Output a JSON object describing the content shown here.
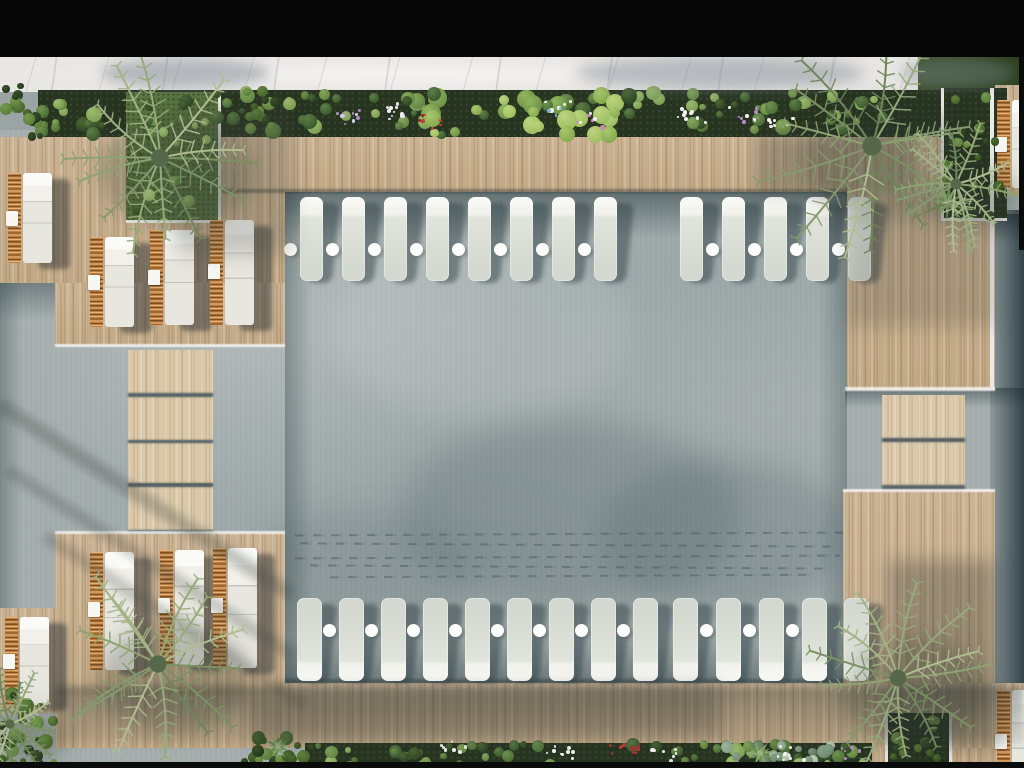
{
  "scene": {
    "w": 1024,
    "h": 768,
    "description": "aerial-top-view-pool-deck-render"
  },
  "colors": {
    "water": "#a6afae",
    "deck_wood": "#c7ae8c",
    "bridge_wood": "#dac8a9",
    "walkway_marble": "#e9e7e4",
    "planter_soil": "#273420",
    "grass": "#5a7440",
    "lounger_white": "#f1f2ec",
    "rattan_orange": "#c07f3e",
    "letterbox": "#060606"
  },
  "palettes": {
    "palm": [
      "#8ea272",
      "#7b9164",
      "#a3b386",
      "#6f855c",
      "#97aa7c",
      "#b0bd90",
      "#86996e"
    ],
    "leaf": [
      [
        "#3c5a2e",
        "#5d7f46"
      ],
      [
        "#4e7038",
        "#6f934e"
      ],
      [
        "#648844",
        "#86a85c"
      ],
      [
        "#2f4724",
        "#4c6636"
      ],
      [
        "#7fa055",
        "#9cbc6e"
      ]
    ],
    "lush": [
      [
        "#4e7038",
        "#6f934e"
      ],
      [
        "#6f9347",
        "#92b55e"
      ],
      [
        "#86ab4f",
        "#a8c86a"
      ],
      [
        "#3c5a2e",
        "#5d7f46"
      ],
      [
        "#9fc063",
        "#bcd47f"
      ]
    ],
    "bush": [
      [
        "#24371d",
        "#3a5229"
      ],
      [
        "#35511f",
        "#4f6e31"
      ],
      [
        "#47662c",
        "#62843e"
      ],
      [
        "#5b7f3a",
        "#77994f"
      ]
    ],
    "sage": [
      [
        "#6f8a70",
        "#8aa38b"
      ],
      [
        "#8aa38b",
        "#a7bba4"
      ],
      [
        "#a7bba4",
        "#c2d0bd"
      ],
      [
        "#5d7660",
        "#7a9480"
      ]
    ]
  },
  "rects": [
    {
      "n": "water-surface",
      "c": "water",
      "x": 0,
      "y": 130,
      "w": 1024,
      "h": 636,
      "z": 1
    },
    {
      "n": "water-sun-glint",
      "x": 330,
      "y": 240,
      "w": 300,
      "h": 180,
      "z": 2,
      "bg": "rgba(255,255,255,.10)",
      "br": "50%",
      "bl": 14
    },
    {
      "n": "water-shadow-blob-1",
      "x": 400,
      "y": 420,
      "w": 340,
      "h": 190,
      "z": 2,
      "bg": "rgba(64,82,88,.22)",
      "br": "50%",
      "bl": 16
    },
    {
      "n": "water-shadow-blob-2",
      "x": 600,
      "y": 460,
      "w": 250,
      "h": 150,
      "z": 2,
      "bg": "rgba(58,78,86,.20)",
      "br": "50%",
      "bl": 14
    },
    {
      "n": "water-shadow-blob-3",
      "x": 240,
      "y": 510,
      "w": 230,
      "h": 130,
      "z": 2,
      "bg": "rgba(70,88,92,.16)",
      "br": "50%",
      "bl": 14
    },
    {
      "n": "pool-edge-shade-top",
      "x": 285,
      "y": 192,
      "w": 562,
      "h": 46,
      "z": 4,
      "bg": "linear-gradient(180deg,rgba(30,50,54,.50),rgba(30,50,54,0))"
    },
    {
      "n": "pool-edge-shade-bottom",
      "x": 285,
      "y": 634,
      "w": 562,
      "h": 49,
      "z": 4,
      "bg": "linear-gradient(0deg,rgba(30,50,54,.40),rgba(30,50,54,0))"
    },
    {
      "n": "pool-edge-shade-left",
      "x": 285,
      "y": 192,
      "w": 28,
      "h": 491,
      "z": 4,
      "bg": "linear-gradient(90deg,rgba(30,50,54,.32),rgba(30,50,54,0))"
    },
    {
      "n": "pool-edge-shade-right",
      "x": 818,
      "y": 192,
      "w": 29,
      "h": 491,
      "z": 4,
      "bg": "linear-gradient(270deg,rgba(30,50,54,.28),rgba(30,50,54,0))"
    },
    {
      "n": "left-arm-shade-top",
      "x": 0,
      "y": 283,
      "w": 128,
      "h": 38,
      "z": 4,
      "bg": "linear-gradient(180deg,rgba(30,50,54,.38),rgba(30,50,54,0))"
    },
    {
      "n": "left-arm-shade-edge",
      "x": 0,
      "y": 283,
      "w": 22,
      "h": 332,
      "z": 4,
      "bg": "linear-gradient(90deg,rgba(30,50,54,.30),rgba(30,50,54,0))"
    },
    {
      "n": "right-channel-water",
      "x": 990,
      "y": 210,
      "w": 34,
      "h": 486,
      "z": 4,
      "bg": "linear-gradient(90deg,rgba(52,74,80,.20),rgba(22,40,48,.80))"
    },
    {
      "n": "right-channel-shade-top",
      "x": 990,
      "y": 214,
      "w": 34,
      "h": 30,
      "z": 5,
      "bg": "linear-gradient(180deg,rgba(18,34,40,.55),rgba(18,34,40,0))"
    },
    {
      "n": "steps-channel-shade",
      "x": 845,
      "y": 388,
      "w": 179,
      "h": 20,
      "z": 5,
      "bg": "linear-gradient(180deg,rgba(24,42,46,.45),rgba(24,42,46,0))"
    },
    {
      "n": "walkway",
      "c": "marble",
      "x": 0,
      "y": 57,
      "w": 1024,
      "h": 35,
      "z": 6
    },
    {
      "n": "lawn-patch",
      "x": 918,
      "y": 57,
      "w": 101,
      "h": 35,
      "z": 7,
      "bg": "linear-gradient(90deg,#3b522d,#2b3f1f)"
    },
    {
      "n": "deck-top-strip",
      "c": "wood",
      "x": 0,
      "y": 137,
      "w": 847,
      "h": 55,
      "z": 10
    },
    {
      "n": "deck-top-left-upper",
      "c": "wood",
      "x": 0,
      "y": 137,
      "w": 285,
      "h": 146,
      "z": 10
    },
    {
      "n": "deck-top-left-lower",
      "c": "wood",
      "x": 55,
      "y": 283,
      "w": 230,
      "h": 62,
      "z": 10
    },
    {
      "n": "deck-right-column",
      "c": "wood",
      "x": 847,
      "y": 137,
      "w": 148,
      "h": 253,
      "z": 10
    },
    {
      "n": "deck-right-lower",
      "c": "wood",
      "x": 843,
      "y": 490,
      "w": 152,
      "h": 278,
      "z": 10
    },
    {
      "n": "deck-bottom-strip",
      "c": "wood",
      "x": 55,
      "y": 683,
      "w": 969,
      "h": 65,
      "z": 10
    },
    {
      "n": "deck-bottom-left-platform",
      "c": "wood",
      "x": 55,
      "y": 533,
      "w": 230,
      "h": 162,
      "z": 10
    },
    {
      "n": "deck-pad-right-top",
      "c": "wood",
      "x": 995,
      "y": 85,
      "w": 29,
      "h": 110,
      "z": 10
    },
    {
      "n": "deck-pad-right-bottom",
      "c": "wood",
      "x": 995,
      "y": 683,
      "w": 29,
      "h": 85,
      "z": 10
    },
    {
      "n": "deck-pad-left",
      "c": "wood",
      "x": 0,
      "y": 608,
      "w": 58,
      "h": 105,
      "z": 10
    },
    {
      "n": "bridge-step-1",
      "c": "woodLight",
      "x": 128,
      "y": 350,
      "w": 85,
      "h": 43,
      "z": 10
    },
    {
      "n": "bridge-step-2",
      "c": "woodLight",
      "x": 128,
      "y": 397,
      "w": 85,
      "h": 43,
      "z": 10
    },
    {
      "n": "bridge-step-3",
      "c": "woodLight",
      "x": 128,
      "y": 443,
      "w": 85,
      "h": 40,
      "z": 10
    },
    {
      "n": "bridge-step-4",
      "c": "woodLight",
      "x": 128,
      "y": 487,
      "w": 85,
      "h": 43,
      "z": 10
    },
    {
      "n": "pool-step-1",
      "c": "woodLight",
      "x": 882,
      "y": 395,
      "w": 83,
      "h": 43,
      "z": 10
    },
    {
      "n": "pool-step-2",
      "c": "woodLight",
      "x": 882,
      "y": 442,
      "w": 83,
      "h": 43,
      "z": 10
    },
    {
      "n": "deck-lip-top",
      "x": 213,
      "y": 189,
      "w": 634,
      "h": 4,
      "z": 11,
      "bg": "rgba(28,42,44,.40)",
      "bl": 1
    },
    {
      "n": "deck-lip-bottom",
      "x": 285,
      "y": 679,
      "w": 562,
      "h": 4,
      "z": 11,
      "bg": "rgba(28,42,44,.35)",
      "bl": 1
    },
    {
      "n": "bridge-gap-1",
      "x": 128,
      "y": 393,
      "w": 85,
      "h": 4,
      "z": 11,
      "bg": "rgba(16,26,28,.55)",
      "bl": 1
    },
    {
      "n": "bridge-gap-2",
      "x": 128,
      "y": 440,
      "w": 85,
      "h": 3,
      "z": 11,
      "bg": "rgba(16,26,28,.55)",
      "bl": 1
    },
    {
      "n": "bridge-gap-3",
      "x": 128,
      "y": 483,
      "w": 85,
      "h": 4,
      "z": 11,
      "bg": "rgba(16,26,28,.55)",
      "bl": 1
    },
    {
      "n": "bridge-gap-4",
      "x": 128,
      "y": 530,
      "w": 85,
      "h": 3,
      "z": 11,
      "bg": "rgba(16,26,28,.50)",
      "bl": 1
    },
    {
      "n": "pool-step-gap-1",
      "x": 882,
      "y": 438,
      "w": 83,
      "h": 4,
      "z": 11,
      "bg": "rgba(16,26,28,.55)",
      "bl": 1
    },
    {
      "n": "pool-step-gap-2",
      "x": 882,
      "y": 485,
      "w": 83,
      "h": 5,
      "z": 11,
      "bg": "rgba(16,26,28,.50)",
      "bl": 1
    },
    {
      "n": "planter-top",
      "c": "planterBed",
      "x": 38,
      "y": 90,
      "w": 905,
      "h": 47,
      "z": 12
    },
    {
      "n": "planter-bottom",
      "c": "planterBed",
      "x": 305,
      "y": 743,
      "w": 567,
      "h": 25,
      "z": 12
    },
    {
      "n": "planter-box-top-right",
      "c": "planterBed",
      "x": 943,
      "y": 88,
      "w": 64,
      "h": 132,
      "z": 12
    },
    {
      "n": "planter-box-bottom-right",
      "c": "planterBed",
      "x": 887,
      "y": 713,
      "w": 65,
      "h": 53,
      "z": 12
    },
    {
      "n": "palm-planter-grass",
      "c": "grass",
      "x": 126,
      "y": 92,
      "w": 92,
      "h": 129,
      "z": 12
    },
    {
      "n": "planter-frame",
      "c": "frame",
      "x": 218,
      "y": 92,
      "w": 3,
      "h": 131,
      "z": 13
    },
    {
      "n": "planter-frame",
      "c": "frame",
      "x": 126,
      "y": 220,
      "w": 95,
      "h": 3,
      "z": 13
    },
    {
      "n": "planter-frame",
      "c": "frame",
      "x": 941,
      "y": 88,
      "w": 3,
      "h": 133,
      "z": 13
    },
    {
      "n": "planter-frame",
      "c": "frame",
      "x": 941,
      "y": 218,
      "w": 66,
      "h": 3,
      "z": 13
    },
    {
      "n": "planter-frame",
      "c": "frame",
      "x": 885,
      "y": 713,
      "w": 3,
      "h": 53,
      "z": 13
    },
    {
      "n": "planter-frame",
      "c": "frame",
      "x": 949,
      "y": 713,
      "w": 3,
      "h": 53,
      "z": 13
    },
    {
      "n": "water-edge-foam",
      "c": "foam",
      "x": 55,
      "y": 344,
      "w": 230,
      "h": 3,
      "z": 15
    },
    {
      "n": "water-edge-foam",
      "c": "foam",
      "x": 55,
      "y": 531,
      "w": 230,
      "h": 3,
      "z": 15
    },
    {
      "n": "water-edge-foam",
      "c": "foam",
      "x": 845,
      "y": 387,
      "w": 150,
      "h": 4,
      "z": 15
    },
    {
      "n": "water-edge-foam",
      "c": "foam",
      "x": 843,
      "y": 489,
      "w": 152,
      "h": 3,
      "z": 15
    },
    {
      "n": "deck-edge-highlight",
      "c": "frame",
      "x": 990,
      "y": 88,
      "w": 4,
      "h": 300,
      "z": 15
    },
    {
      "n": "shadow-overlay",
      "x": 100,
      "y": 58,
      "w": 170,
      "h": 30,
      "z": 30,
      "bg": "rgba(124,134,146,.50)",
      "br": "50%",
      "bl": 6
    },
    {
      "n": "shadow-overlay",
      "x": 575,
      "y": 56,
      "w": 290,
      "h": 34,
      "z": 30,
      "bg": "rgba(118,128,140,.45)",
      "br": "50%",
      "bl": 7
    },
    {
      "n": "shadow-overlay",
      "x": 900,
      "y": 58,
      "w": 115,
      "h": 30,
      "z": 30,
      "bg": "rgba(124,134,146,.40)",
      "br": "50%",
      "bl": 6
    },
    {
      "n": "shadow-overlay",
      "x": 176,
      "y": 110,
      "w": 115,
      "h": 145,
      "z": 30,
      "bg": "rgba(62,66,60,.25)",
      "bl": 9
    },
    {
      "n": "shadow-overlay",
      "x": 756,
      "y": 134,
      "w": 160,
      "h": 60,
      "z": 30,
      "bg": "rgba(52,58,54,.30)",
      "bl": 7
    },
    {
      "n": "shadow-overlay",
      "x": 846,
      "y": 196,
      "w": 150,
      "h": 130,
      "z": 30,
      "bg": "rgba(58,64,60,.22)",
      "bl": 9
    },
    {
      "n": "shadow-overlay",
      "x": 55,
      "y": 686,
      "w": 969,
      "h": 58,
      "z": 30,
      "bg": "linear-gradient(180deg,rgba(40,48,46,.40),rgba(40,48,46,.10))",
      "bl": 4
    },
    {
      "n": "shadow-overlay",
      "x": -30,
      "y": 492,
      "w": 350,
      "h": 15,
      "z": 30,
      "bg": "rgba(66,72,66,.30)",
      "bl": 4,
      "rot": 33
    },
    {
      "n": "shadow-overlay",
      "x": -20,
      "y": 556,
      "w": 340,
      "h": 13,
      "z": 30,
      "bg": "rgba(66,72,66,.26)",
      "bl": 4,
      "rot": 33
    },
    {
      "n": "shadow-overlay",
      "x": 20,
      "y": 614,
      "w": 310,
      "h": 13,
      "z": 30,
      "bg": "rgba(66,72,66,.24)",
      "bl": 4,
      "rot": 33
    },
    {
      "n": "shadow-overlay",
      "x": 888,
      "y": 560,
      "w": 108,
      "h": 190,
      "z": 30,
      "bg": "rgba(44,50,46,.30)",
      "bl": 9
    },
    {
      "n": "shadow-overlay",
      "x": 250,
      "y": 688,
      "w": 470,
      "h": 52,
      "z": 30,
      "bg": "rgba(46,52,50,.26)",
      "bl": 9,
      "rot": -1
    },
    {
      "n": "letterbox-top",
      "x": 0,
      "y": 0,
      "w": 1024,
      "h": 57,
      "z": 50,
      "bg": "#060606"
    },
    {
      "n": "letterbox-bottom",
      "x": 0,
      "y": 762,
      "w": 1024,
      "h": 6,
      "z": 50,
      "bg": "#0a0c0c"
    },
    {
      "n": "frame-right-sliver",
      "x": 1019,
      "y": 57,
      "w": 5,
      "h": 193,
      "z": 50,
      "bg": "#0a0c0c"
    }
  ],
  "ripples": [
    {
      "x": 295,
      "y": 533,
      "w": 548
    },
    {
      "x": 300,
      "y": 544,
      "w": 540
    },
    {
      "x": 295,
      "y": 556,
      "w": 545
    },
    {
      "x": 310,
      "y": 566,
      "w": 520
    },
    {
      "x": 330,
      "y": 575,
      "w": 480
    }
  ],
  "rows": [
    {
      "id": "top-lounger-row",
      "y": 197,
      "h": 84,
      "w": 23,
      "dir": "down",
      "dotTop": 46,
      "groups": [
        {
          "x0": 300,
          "n": 8,
          "sp": 42,
          "dots": "all"
        },
        {
          "x0": 680,
          "n": 5,
          "sp": 42,
          "dots": "skipFirst"
        }
      ]
    },
    {
      "id": "bottom-lounger-row",
      "y": 598,
      "h": 83,
      "w": 25,
      "dir": "up",
      "dotTop": 26,
      "groups": [
        {
          "x0": 297,
          "n": 9,
          "sp": 42,
          "dots": "skipFirst"
        },
        {
          "x0": 673,
          "n": 4,
          "sp": 43,
          "dots": "skipFirst"
        },
        {
          "x0": 844,
          "n": 1,
          "sp": 43,
          "dots": "none"
        }
      ]
    }
  ],
  "pairs": [
    {
      "x": 8,
      "y": 173,
      "h": 90
    },
    {
      "x": 90,
      "y": 237,
      "h": 90
    },
    {
      "x": 150,
      "y": 230,
      "h": 95
    },
    {
      "x": 210,
      "y": 220,
      "h": 105
    },
    {
      "x": 5,
      "y": 617,
      "h": 88
    },
    {
      "x": 90,
      "y": 552,
      "h": 118
    },
    {
      "x": 160,
      "y": 550,
      "h": 115
    },
    {
      "x": 213,
      "y": 548,
      "h": 120
    },
    {
      "x": 997,
      "y": 100,
      "h": 88
    },
    {
      "x": 997,
      "y": 690,
      "h": 105
    }
  ],
  "palms": [
    {
      "cx": 160,
      "cy": 158,
      "r": 110,
      "s": 11
    },
    {
      "cx": 872,
      "cy": 146,
      "r": 120,
      "s": 23
    },
    {
      "cx": 956,
      "cy": 184,
      "r": 68,
      "s": 31
    },
    {
      "cx": 158,
      "cy": 664,
      "r": 108,
      "s": 47
    },
    {
      "cx": 898,
      "cy": 678,
      "r": 104,
      "s": 59
    },
    {
      "cx": 10,
      "cy": 724,
      "r": 58,
      "s": 71
    }
  ],
  "agaves": [
    {
      "cx": 948,
      "cy": 202,
      "r": 24,
      "s": 5
    },
    {
      "cx": 760,
      "cy": 753,
      "r": 14,
      "s": 9
    },
    {
      "cx": 278,
      "cy": 746,
      "r": 12,
      "s": 21
    }
  ],
  "clusters": [
    {
      "x": 40,
      "y": 92,
      "w": 190,
      "h": 42,
      "n": 26,
      "p": "leaf",
      "r1": 3,
      "r2": 8,
      "s": 5
    },
    {
      "x": 232,
      "y": 92,
      "w": 196,
      "h": 42,
      "n": 30,
      "p": "leaf",
      "r1": 3,
      "r2": 8,
      "s": 6
    },
    {
      "x": 430,
      "y": 90,
      "w": 186,
      "h": 46,
      "n": 34,
      "p": "lush",
      "r1": 4,
      "r2": 11,
      "s": 7
    },
    {
      "x": 618,
      "y": 92,
      "w": 186,
      "h": 42,
      "n": 28,
      "p": "leaf",
      "r1": 3,
      "r2": 8,
      "s": 8
    },
    {
      "x": 806,
      "y": 94,
      "w": 80,
      "h": 40,
      "n": 12,
      "p": "leaf",
      "r1": 3,
      "r2": 7,
      "s": 9
    },
    {
      "x": 0,
      "y": 84,
      "w": 40,
      "h": 56,
      "n": 16,
      "p": "bush",
      "r1": 3,
      "r2": 7,
      "s": 10
    },
    {
      "x": 246,
      "y": 88,
      "w": 30,
      "h": 48,
      "n": 12,
      "p": "bush",
      "r1": 3,
      "r2": 6,
      "s": 11
    },
    {
      "x": 945,
      "y": 94,
      "w": 56,
      "h": 122,
      "n": 18,
      "p": "bush",
      "r1": 3,
      "r2": 7,
      "s": 12
    },
    {
      "x": 314,
      "y": 744,
      "w": 556,
      "h": 21,
      "n": 60,
      "p": "leaf",
      "r1": 3,
      "r2": 7,
      "s": 13
    },
    {
      "x": 726,
      "y": 744,
      "w": 112,
      "h": 21,
      "n": 16,
      "p": "sage",
      "r1": 3,
      "r2": 7,
      "s": 14
    },
    {
      "x": 0,
      "y": 688,
      "w": 56,
      "h": 78,
      "n": 26,
      "p": "bush",
      "r1": 3,
      "r2": 8,
      "s": 15
    },
    {
      "x": 243,
      "y": 732,
      "w": 74,
      "h": 34,
      "n": 18,
      "p": "bush",
      "r1": 3,
      "r2": 7,
      "s": 16
    },
    {
      "x": 890,
      "y": 716,
      "w": 58,
      "h": 46,
      "n": 14,
      "p": "bush",
      "r1": 3,
      "r2": 7,
      "s": 17
    },
    {
      "x": 128,
      "y": 96,
      "w": 88,
      "h": 120,
      "n": 14,
      "p": "leaf",
      "r1": 3,
      "r2": 6,
      "s": 18
    }
  ],
  "flowers": [
    {
      "cx": 400,
      "cy": 110,
      "n": 12,
      "cols": [
        "#f2f0f4",
        "#e3dced"
      ]
    },
    {
      "cx": 348,
      "cy": 116,
      "n": 10,
      "cols": [
        "#cdd2e2",
        "#b18cc6"
      ]
    },
    {
      "cx": 432,
      "cy": 120,
      "n": 7,
      "cols": [
        "#bf4038",
        "#8f2d28"
      ]
    },
    {
      "cx": 558,
      "cy": 107,
      "n": 10,
      "cols": [
        "#86b2d6",
        "#f0f2f4"
      ]
    },
    {
      "cx": 588,
      "cy": 118,
      "n": 9,
      "cols": [
        "#cf86b8",
        "#f2eef0"
      ]
    },
    {
      "cx": 690,
      "cy": 114,
      "n": 9,
      "cols": [
        "#f2f2ef"
      ]
    },
    {
      "cx": 742,
      "cy": 112,
      "n": 10,
      "cols": [
        "#b18cc6",
        "#f0eef4"
      ]
    },
    {
      "cx": 778,
      "cy": 118,
      "n": 8,
      "cols": [
        "#f2f2ef"
      ]
    },
    {
      "cx": 452,
      "cy": 748,
      "n": 7,
      "cols": [
        "#f2f2ef"
      ]
    },
    {
      "cx": 560,
      "cy": 752,
      "n": 9,
      "cols": [
        "#f2f2ef"
      ]
    },
    {
      "cx": 622,
      "cy": 750,
      "n": 10,
      "cols": [
        "#bf4038",
        "#a03530"
      ]
    },
    {
      "cx": 662,
      "cy": 754,
      "n": 8,
      "cols": [
        "#f2f0f4",
        "#e3dced"
      ]
    },
    {
      "cx": 790,
      "cy": 752,
      "n": 8,
      "cols": [
        "#f2f2ef"
      ]
    },
    {
      "cx": 852,
      "cy": 750,
      "n": 7,
      "cols": [
        "#b18cc6"
      ]
    }
  ]
}
